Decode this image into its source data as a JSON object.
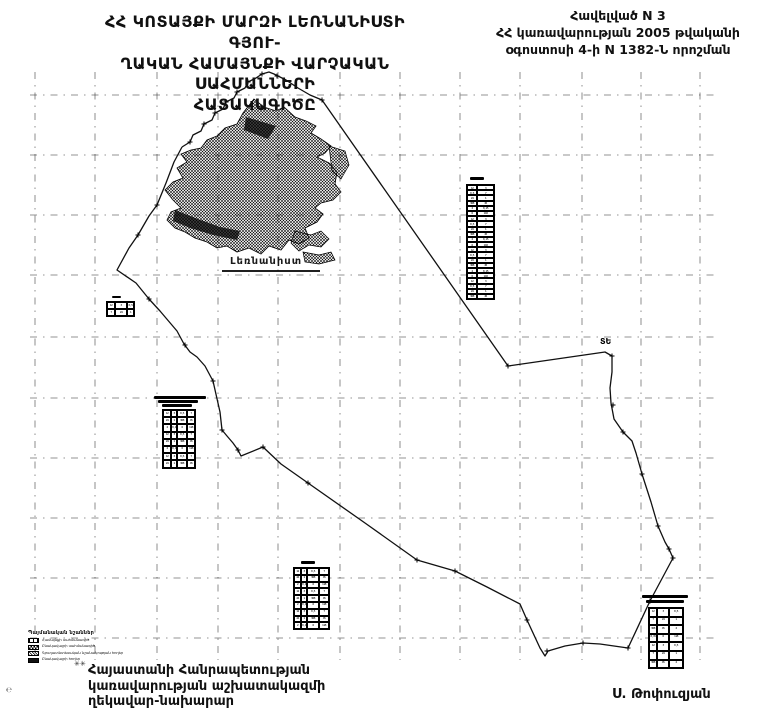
{
  "title_block": {
    "line1": "ՀՀ  ԿՈՏԱՅՔԻ  ՄԱՐԶԻ  ԼԵՌՆԱՆԻՍՏԻ  ԳՅՈՒ-",
    "line2": "ՂԱԿԱՆ ՀԱՄԱՅՆՔԻ ՎԱՐՉԱԿԱՆ ՍԱՀՄԱՆՆԵՐԻ",
    "line3": "ՀԱՏԱԿԱԳԻԾԸ"
  },
  "annex_block": {
    "line1": "Հավելված N 3",
    "line2": "ՀՀ կառավարության 2005 թվականի",
    "line3": "օգոստոսի 4-ի N 1382-Ն որոշման"
  },
  "footer_block": {
    "line1": "Հայաստանի Հանրապետության",
    "line2": "կառավարության աշխատակազմի",
    "line3": "ղեկավար-նախարար",
    "signature": "Ս. Թոփուզյան",
    "scan_mark": "✳✳",
    "corner_mark": "℮"
  },
  "legend": {
    "title": "Պայմանական նշաններ",
    "items": [
      {
        "symbol": "boundary-line-symbol",
        "style": "outline",
        "label": "Համայնքի սահմանագիծ"
      },
      {
        "symbol": "settlement-area-symbol",
        "style": "checker",
        "label": "Բնակավայրի սահմանագիծ"
      },
      {
        "symbol": "agricultural-land-symbol",
        "style": "hatch",
        "label": "Գյուղատնտեսական նշանակության հողեր"
      },
      {
        "symbol": "other-land-symbol",
        "style": "solid",
        "label": "Բնակավայրի հողեր"
      }
    ]
  },
  "map": {
    "settlement_label": "Լեռնանիստ",
    "boundary_marker_label": "ՏԵ",
    "ink_color": "#111111",
    "grid_color": "#3a3a3a",
    "grid_x": [
      35,
      95,
      157,
      218,
      278,
      340,
      400,
      460,
      520,
      582,
      641,
      700
    ],
    "grid_y": [
      95,
      155,
      215,
      275,
      337,
      398,
      458,
      518,
      578,
      638
    ],
    "grid_span": {
      "x1": 30,
      "x2": 716,
      "y1": 72,
      "y2": 660
    },
    "boundary_points": [
      [
        182,
        147
      ],
      [
        190,
        142
      ],
      [
        193,
        135
      ],
      [
        201,
        131
      ],
      [
        204,
        124
      ],
      [
        212,
        120
      ],
      [
        215,
        113
      ],
      [
        223,
        109
      ],
      [
        226,
        102
      ],
      [
        234,
        98
      ],
      [
        237,
        92
      ],
      [
        245,
        88
      ],
      [
        248,
        82
      ],
      [
        256,
        78
      ],
      [
        262,
        74
      ],
      [
        269,
        72
      ],
      [
        274,
        74
      ],
      [
        286,
        80
      ],
      [
        298,
        88
      ],
      [
        310,
        95
      ],
      [
        322,
        100
      ],
      [
        508,
        366
      ],
      [
        605,
        352
      ],
      [
        612,
        356
      ],
      [
        612,
        372
      ],
      [
        610,
        388
      ],
      [
        611,
        403
      ],
      [
        614,
        419
      ],
      [
        623,
        432
      ],
      [
        632,
        441
      ],
      [
        636,
        453
      ],
      [
        642,
        474
      ],
      [
        651,
        502
      ],
      [
        658,
        526
      ],
      [
        665,
        542
      ],
      [
        669,
        549
      ],
      [
        673,
        558
      ],
      [
        650,
        601
      ],
      [
        628,
        648
      ],
      [
        600,
        644
      ],
      [
        583,
        643
      ],
      [
        565,
        646
      ],
      [
        548,
        651
      ],
      [
        545,
        656
      ],
      [
        540,
        648
      ],
      [
        527,
        620
      ],
      [
        520,
        604
      ],
      [
        487,
        587
      ],
      [
        455,
        571
      ],
      [
        417,
        560
      ],
      [
        365,
        523
      ],
      [
        308,
        483
      ],
      [
        281,
        464
      ],
      [
        263,
        447
      ],
      [
        241,
        456
      ],
      [
        238,
        450
      ],
      [
        233,
        443
      ],
      [
        227,
        436
      ],
      [
        222,
        430
      ],
      [
        220,
        412
      ],
      [
        213,
        381
      ],
      [
        205,
        366
      ],
      [
        197,
        357
      ],
      [
        190,
        352
      ],
      [
        184,
        344
      ],
      [
        177,
        331
      ],
      [
        160,
        311
      ],
      [
        149,
        299
      ],
      [
        136,
        283
      ],
      [
        117,
        270
      ],
      [
        129,
        248
      ],
      [
        138,
        235
      ],
      [
        149,
        216
      ],
      [
        157,
        205
      ],
      [
        166,
        183
      ],
      [
        174,
        162
      ],
      [
        182,
        147
      ]
    ],
    "cross_marks": [
      [
        190,
        142
      ],
      [
        204,
        124
      ],
      [
        215,
        113
      ],
      [
        226,
        102
      ],
      [
        237,
        92
      ],
      [
        248,
        82
      ],
      [
        262,
        74
      ],
      [
        277,
        76
      ],
      [
        322,
        100
      ],
      [
        508,
        366
      ],
      [
        612,
        356
      ],
      [
        613,
        405
      ],
      [
        623,
        432
      ],
      [
        642,
        474
      ],
      [
        658,
        526
      ],
      [
        669,
        549
      ],
      [
        673,
        558
      ],
      [
        650,
        601
      ],
      [
        628,
        648
      ],
      [
        583,
        643
      ],
      [
        547,
        651
      ],
      [
        527,
        620
      ],
      [
        455,
        571
      ],
      [
        417,
        560
      ],
      [
        308,
        483
      ],
      [
        263,
        447
      ],
      [
        238,
        450
      ],
      [
        222,
        430
      ],
      [
        213,
        381
      ],
      [
        185,
        345
      ],
      [
        149,
        299
      ],
      [
        138,
        235
      ],
      [
        157,
        205
      ]
    ],
    "road_segment": [
      [
        222,
        271
      ],
      [
        320,
        271
      ]
    ],
    "settlement_outline": "M254,99 L264,107 L276,111 L284,107 L295,117 L306,121 L316,126 L311,133 L321,139 L331,146 L325,153 L317,157 L329,163 L337,172 L335,184 L341,192 L333,200 L321,203 L315,208 L323,214 L317,222 L305,228 L309,238 L299,244 L289,240 L281,250 L269,246 L261,254 L249,248 L237,252 L227,246 L217,248 L207,242 L195,238 L185,232 L175,228 L167,220 L171,212 L181,208 L173,200 L165,190 L173,182 L183,178 L177,168 L187,162 L181,154 L191,150 L201,148 L207,140 L217,136 L225,128 L237,124 L243,113 Z",
    "settlement_blobs": [
      "M295,231 L311,235 L321,231 L329,239 L321,247 L309,245 L299,251 L291,243 Z",
      "M303,252 L319,255 L331,252 L335,260 L319,264 L305,262 Z",
      "M329,146 L345,151 L349,165 L341,179 L332,171 Z"
    ],
    "dark_patches": [
      "M175,210 L198,219 L220,227 L240,231 L237,240 L213,235 L190,228 L173,221 Z",
      "M246,117 L276,126 L268,139 L244,130 Z"
    ]
  },
  "tables": {
    "cells_pattern": [
      "12",
      "3",
      "0,5",
      "7",
      "24",
      "1",
      "368",
      "45",
      "2",
      "0,15",
      "6",
      "118"
    ],
    "items": [
      {
        "id": "parcel-table-tall",
        "x": 466,
        "y": 184,
        "cols": [
          10,
          17
        ],
        "rows": 22,
        "rowH": 5.2,
        "caption_bars": [
          {
            "dx": 4,
            "dy": -7,
            "w": 14,
            "h": 3
          }
        ]
      },
      {
        "id": "parcel-table-small-left",
        "x": 106,
        "y": 301,
        "cols": [
          8,
          12,
          7
        ],
        "rows": 2,
        "rowH": 7,
        "caption_bars": [
          {
            "dx": 6,
            "dy": -5,
            "w": 9,
            "h": 2
          }
        ]
      },
      {
        "id": "parcel-table-mid-left",
        "x": 162,
        "y": 409,
        "cols": [
          8,
          6,
          10,
          8
        ],
        "rows": 8,
        "rowH": 7.2,
        "caption_bars": [
          {
            "dx": -8,
            "dy": -13,
            "w": 52,
            "h": 2.5
          },
          {
            "dx": -4,
            "dy": -9,
            "w": 40,
            "h": 2.5
          },
          {
            "dx": 0,
            "dy": -5,
            "w": 30,
            "h": 2.5
          }
        ]
      },
      {
        "id": "parcel-table-bottom-center",
        "x": 293,
        "y": 567,
        "cols": [
          7,
          6,
          12,
          10
        ],
        "rows": 9,
        "rowH": 6.8,
        "caption_bars": [
          {
            "dx": 8,
            "dy": -6,
            "w": 14,
            "h": 3
          }
        ]
      },
      {
        "id": "parcel-table-bottom-right",
        "x": 648,
        "y": 607,
        "cols": [
          8,
          12,
          14
        ],
        "rows": 7,
        "rowH": 8.6,
        "caption_bars": [
          {
            "dx": -6,
            "dy": -12,
            "w": 46,
            "h": 3
          },
          {
            "dx": -2,
            "dy": -7,
            "w": 38,
            "h": 2.5
          }
        ]
      }
    ]
  }
}
